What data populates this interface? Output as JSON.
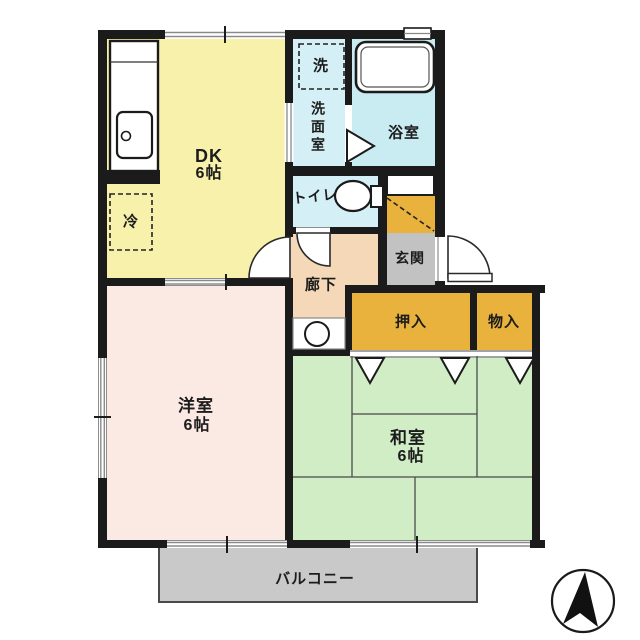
{
  "floorplan": {
    "title": "apartment-floor-plan-2dk",
    "rooms": {
      "dk": {
        "label": "DK",
        "size": "6帖"
      },
      "washroom": {
        "label": "洗面室"
      },
      "bathroom": {
        "label": "浴室"
      },
      "toilet": {
        "label": "トイレ"
      },
      "hallway": {
        "label": "廊下"
      },
      "entrance": {
        "label": "玄関"
      },
      "closet": {
        "label": "押入"
      },
      "storage": {
        "label": "物入"
      },
      "western_room": {
        "label": "洋室",
        "size": "6帖"
      },
      "japanese_room": {
        "label": "和室",
        "size": "6帖"
      },
      "balcony": {
        "label": "バルコニー"
      }
    },
    "fixtures": {
      "refrigerator": {
        "label": "冷"
      },
      "washer": {
        "label": "洗"
      }
    },
    "icons": {
      "compass": "north-arrow"
    },
    "colors": {
      "wall": "#1b1b1b",
      "dk": "#f7f1ac",
      "western_room": "#fbe9e4",
      "japanese_room": "#d0edc6",
      "wet_area": "#d4eff5",
      "bathroom": "#c9ebf2",
      "hallway": "#f4d8b8",
      "entrance": "#c2c2c2",
      "closet": "#e9b23c",
      "balcony": "#c9c9c9"
    }
  }
}
